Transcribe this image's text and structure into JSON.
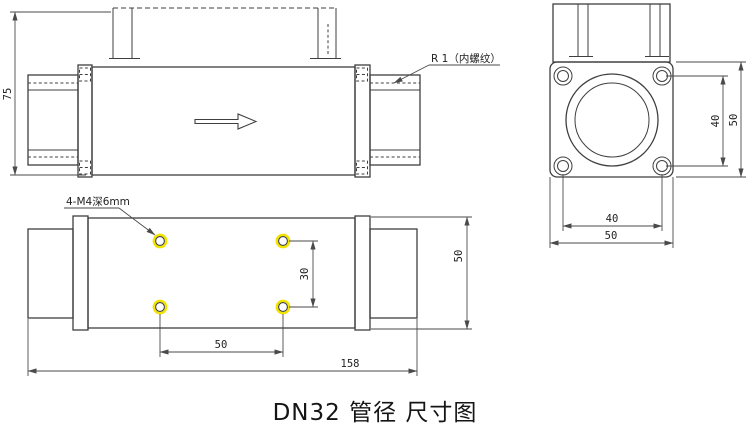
{
  "title": "DN32 管径 尺寸图",
  "colors": {
    "line": "#3f3f3f",
    "dim": "#4a4a4a",
    "highlight": "#f2e400",
    "text": "#222222",
    "background": "#ffffff"
  },
  "views": {
    "side": {
      "labels": {
        "thread": "R 1（内螺纹）"
      },
      "dims": {
        "overall_height": "75"
      }
    },
    "end": {
      "dims": {
        "bolt_spacing_vertical": "40",
        "flange_height": "50",
        "bolt_spacing_horizontal": "40",
        "flange_width": "50"
      }
    },
    "plan": {
      "labels": {
        "holes": "4-M4深6mm"
      },
      "dims": {
        "hole_spacing_vertical": "30",
        "hole_spacing_horizontal": "50",
        "overall_length": "158",
        "body_width": "50"
      }
    }
  }
}
